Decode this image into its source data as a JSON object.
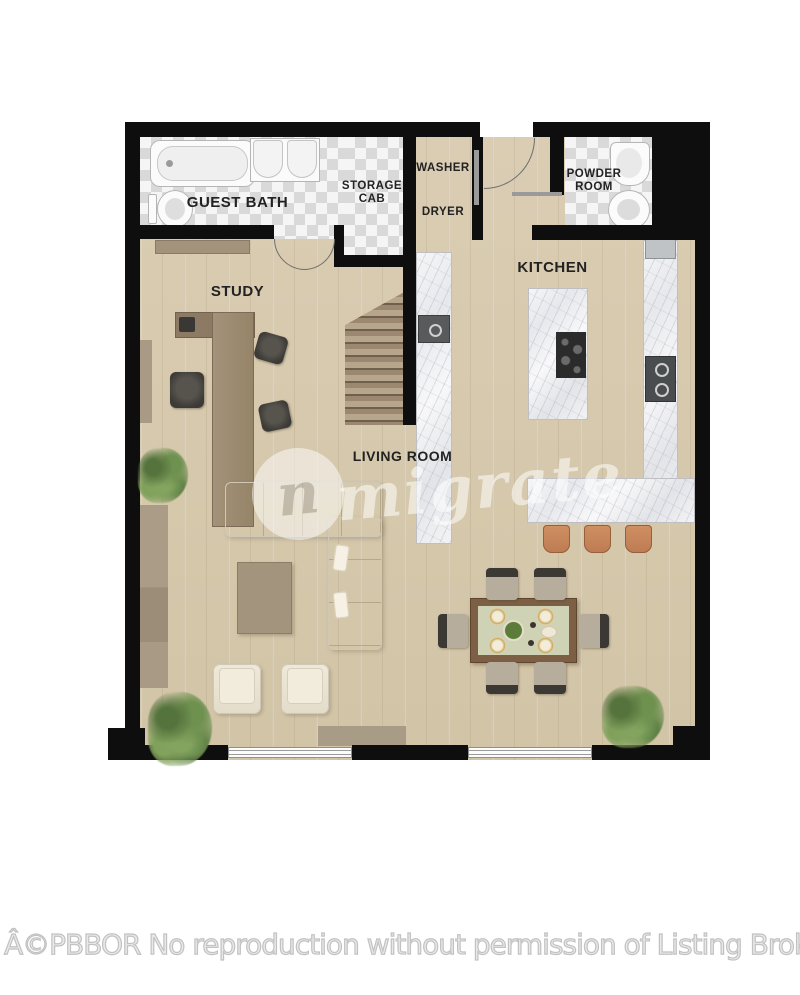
{
  "plan": {
    "labels": {
      "guest_bath": "GUEST BATH",
      "storage_line1": "STORAGE",
      "storage_line2": "CAB",
      "washer": "WASHER",
      "dryer": "DRYER",
      "powder_line1": "POWDER",
      "powder_line2": "ROOM",
      "study": "STUDY",
      "kitchen": "KITCHEN",
      "living_room": "LIVING ROOM"
    },
    "colors": {
      "wall": "#0e0e0e",
      "wood_floor": "#d7c9ad",
      "tile_light": "#f5f5f5",
      "tile_dark": "#d9d9d9",
      "marble": "#f0f0f2",
      "stair": "#9c8871",
      "sofa": "#eae3d3",
      "stool": "#bd7b52",
      "table": "#7d5f45",
      "runner": "#cfd2b4",
      "plant": "#6f9150"
    }
  },
  "watermark": {
    "logo_letter": "n",
    "brand": "migrate"
  },
  "footer": {
    "copyright": "Â©PBBOR No reproduction without permission of Listing Broker"
  }
}
